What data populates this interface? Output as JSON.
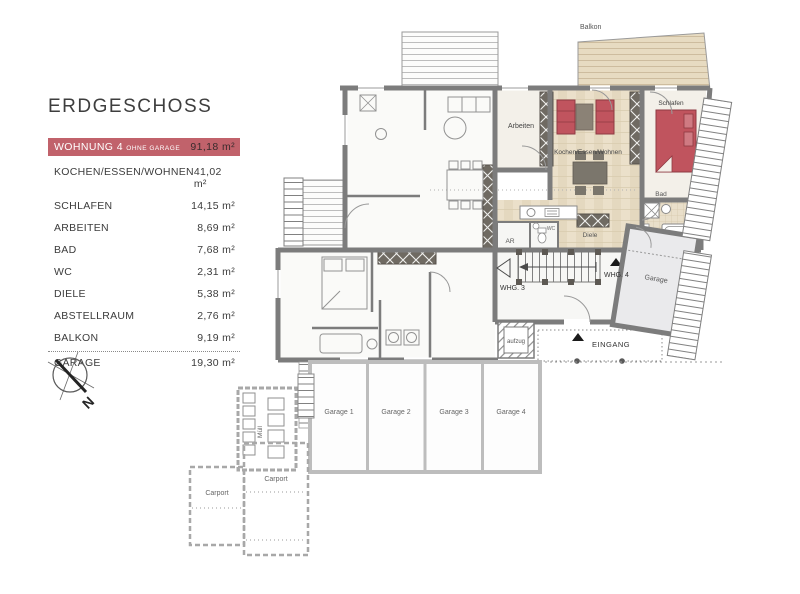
{
  "legend": {
    "title": "ERDGESCHOSS",
    "highlight": {
      "name": "WOHNUNG 4",
      "suffix": "OHNE GARAGE",
      "area": "91,18 m²"
    },
    "rows": [
      {
        "label": "KOCHEN/ESSEN/WOHNEN",
        "area": "41,02 m²"
      },
      {
        "label": "SCHLAFEN",
        "area": "14,15 m²"
      },
      {
        "label": "ARBEITEN",
        "area": "8,69 m²"
      },
      {
        "label": "BAD",
        "area": "7,68 m²"
      },
      {
        "label": "WC",
        "area": "2,31 m²"
      },
      {
        "label": "DIELE",
        "area": "5,38 m²"
      },
      {
        "label": "ABSTELLRAUM",
        "area": "2,76 m²"
      },
      {
        "label": "BALKON",
        "area": "9,19 m²"
      },
      {
        "label": "GARAGE",
        "area": "19,30 m²"
      }
    ]
  },
  "compass": {
    "north": "N"
  },
  "plan": {
    "rooms": {
      "balkon": "Balkon",
      "arbeiten": "Arbeiten",
      "wohnen": "Kochen/Essen/Wohnen",
      "schlafen": "Schlafen",
      "bad": "Bad",
      "diele": "Diele",
      "ar": "AR",
      "wc": "WC",
      "whg4": "WHG. 4",
      "whg3": "WHG. 3",
      "aufzug": "aufzug",
      "eingang": "EINGANG",
      "garage": "Garage",
      "garage1": "Garage 1",
      "garage2": "Garage 2",
      "garage3": "Garage 3",
      "garage4": "Garage 4",
      "carport1": "Carport",
      "carport2": "Carport",
      "muell": "Müll"
    },
    "colors": {
      "accent": "#c1626b",
      "sofa": "#c0545e",
      "wall": "#7c7c7c",
      "wood": "#ebe0ca",
      "tile": "#e9dfca"
    }
  }
}
